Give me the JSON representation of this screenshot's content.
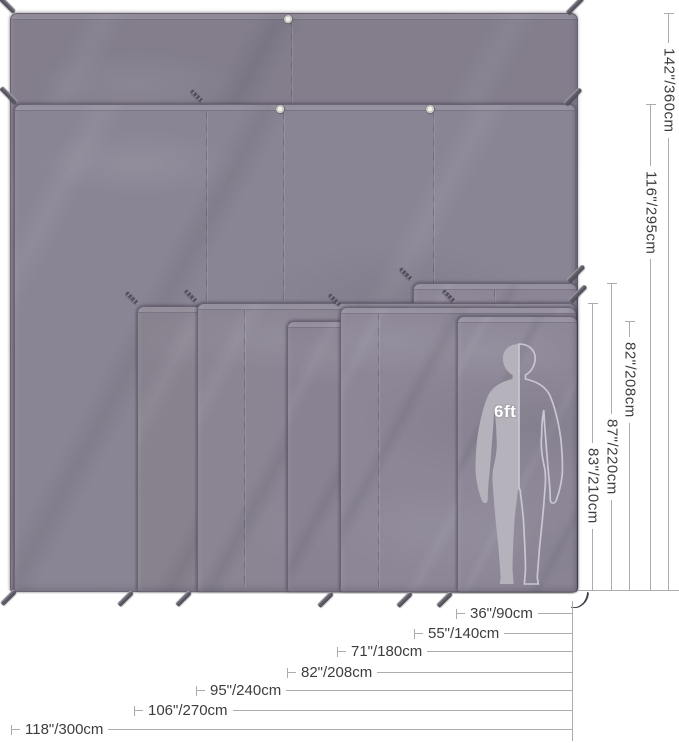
{
  "diagram": {
    "person_label": "6ft",
    "width_dims": [
      {
        "label": "36\"/90cm"
      },
      {
        "label": "55\"/140cm"
      },
      {
        "label": "71\"/180cm"
      },
      {
        "label": "82\"/208cm"
      },
      {
        "label": "95\"/240cm"
      },
      {
        "label": "106\"/270cm"
      },
      {
        "label": "118\"/300cm"
      }
    ],
    "height_dims": [
      {
        "label": "83\"/210cm"
      },
      {
        "label": "87\"/220cm"
      },
      {
        "label": "82\"/208cm"
      },
      {
        "label": "116\"/295cm"
      },
      {
        "label": "142\"/360cm"
      }
    ],
    "colors": {
      "tarp_base": "#8a8594",
      "tarp_dark": "#7e7888",
      "dim_line": "#ababab",
      "dim_text": "#3d3d3d",
      "figure_fill": "#b5b2bc",
      "figure_outline": "#c9c6d1",
      "stake": "#56525c"
    }
  }
}
